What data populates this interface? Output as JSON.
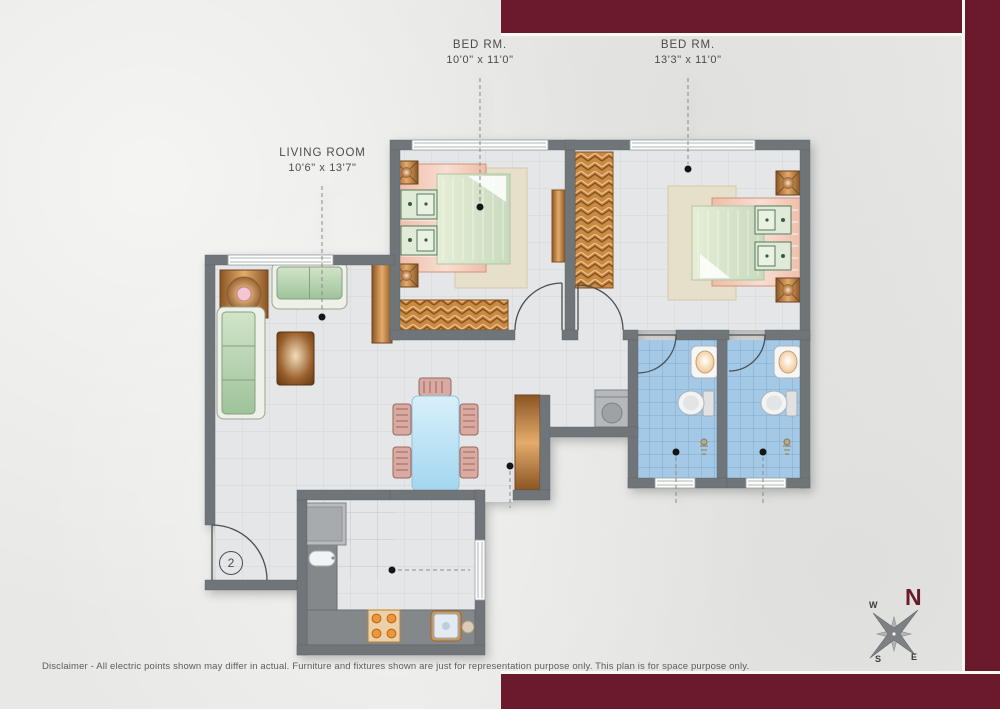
{
  "title_labels": {
    "bedroom1": {
      "line1": "BED RM.",
      "line2": "10'0\" x 11'0\""
    },
    "bedroom2": {
      "line1": "BED RM.",
      "line2": "13'3\" x 11'0\""
    },
    "living": {
      "line1": "LIVING ROOM",
      "line2": "10'6\" x 13'7\""
    }
  },
  "entrance": {
    "unit_number": "2"
  },
  "compass": {
    "north": "N",
    "south": "S",
    "east": "E",
    "west": "W"
  },
  "disclaimer": "Disclaimer - All electric points shown may differ in actual. Furniture and fixtures shown are just for representation purpose only. This plan is for space purpose only.",
  "colors": {
    "accent": "#6a1a2b",
    "wall": "#70757a",
    "floor": "#e4e6e8",
    "bath-floor": "#a4c9e6",
    "paper": "#e8e8e6",
    "label-text": "#4c4c4c"
  }
}
